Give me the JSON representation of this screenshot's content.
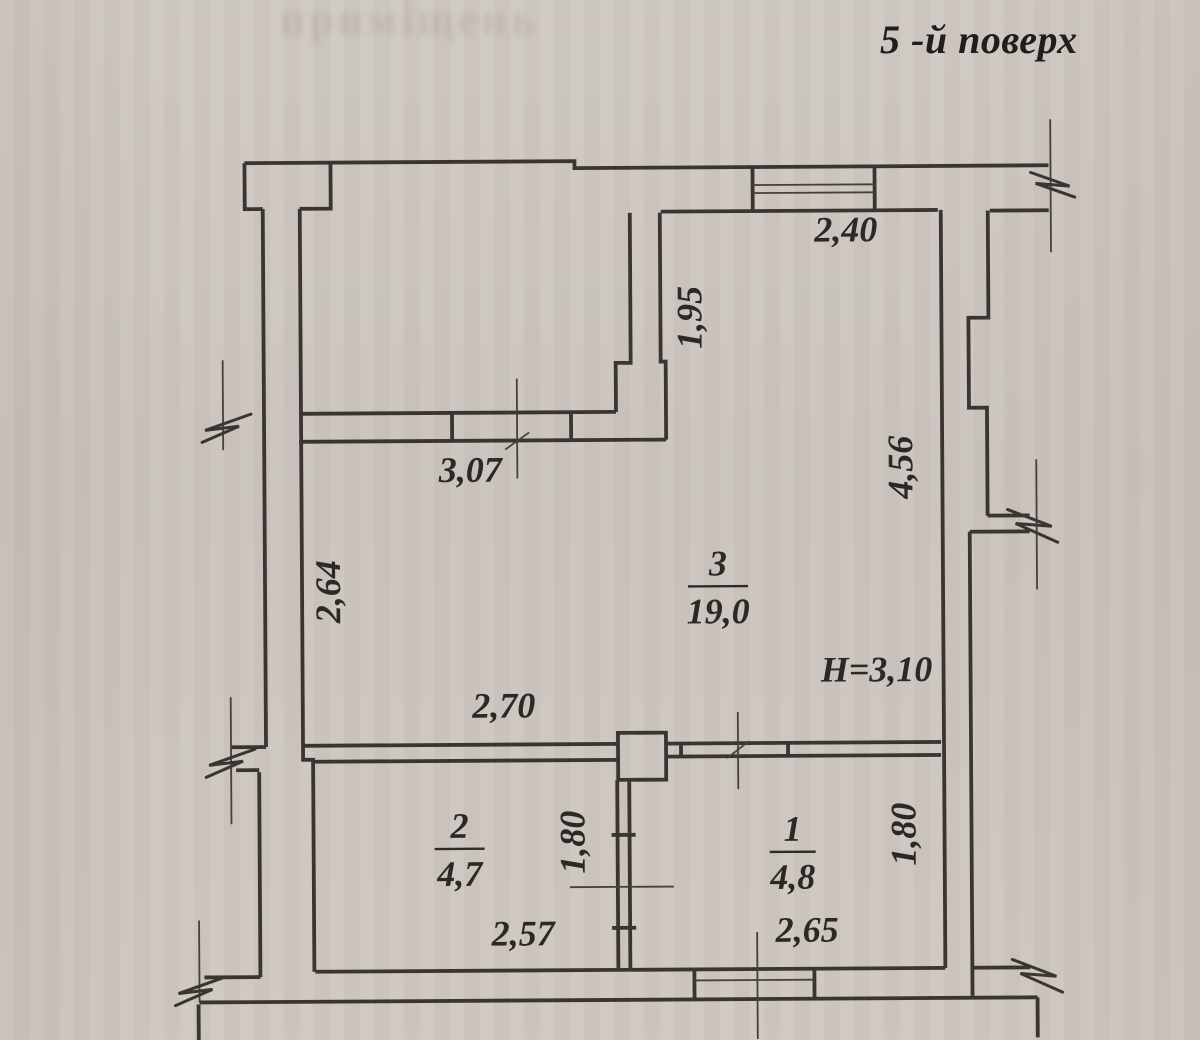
{
  "title": "5 -й поверх",
  "bleed_text": "приміщень",
  "colors": {
    "paper": "#cdc6c0",
    "ink": "#3a3531"
  },
  "floorplan": {
    "ceiling_height_note": "H=3,10",
    "walls": [
      "M247,161 H577 V168 H1051",
      "M247,161 V207 H265",
      "M302,207 H333 V161",
      "M265,207 V745",
      "M302,207 V758 H312 V970",
      "M258,770 V975",
      "M265,745 H230",
      "M258,768 H235",
      "M302,412 H617",
      "M300,440 H667",
      "M453,412 V440",
      "M572,412 V440",
      "M632,213 V363 H617 V412",
      "M662,213 V362 H667 V440",
      "M663,212 H940",
      "M755,168 V212",
      "M877,168 V212",
      "M943,212 V970",
      "M990,213 V320 H970 V410 H988 V518",
      "M992,213 H1051",
      "M988,518 H1030",
      "M970,534 H1030",
      "M970,534 V998",
      "M313,970 H943",
      "M692,970 V1000",
      "M812,970 V1000",
      "M197,1000 H1035",
      "M1035,1000 V1040",
      "M196,1002 V1040",
      "M258,975 H202",
      "M970,970 H1028",
      "M665,744 H940",
      "M665,757 H940",
      "M680,744 V757",
      "M787,744 V757",
      "M302,744 H617",
      "M312,760 H617",
      "M617,733 H665 V780 H617 Z",
      "M616,780 V970",
      "M628,780 V970",
      "M610,835 H634",
      "M610,928 H634"
    ],
    "thin_lines": [
      "M755,186 H877",
      "M755,194 H877",
      "M692,981 H812",
      "M518,378 V478",
      "M737,713 V790",
      "M568,887 H672",
      "M755,933 V1040",
      "M230,695 V822",
      "M224,358 V448",
      "M197,918 V1000",
      "M1037,462 V592",
      "M1053,122 V255",
      "M506,449 L530,432",
      "M726,759 L748,742"
    ],
    "break_marks": [
      "M252,412 L206,428 L240,424 L203,440",
      "M254,747 L208,763 L242,759 L205,775",
      "M222,975 L176,991 L210,987 L173,1003",
      "M1033,175 L1072,189 L1038,186 L1077,200",
      "M1008,512 L1052,529 L1016,526 L1058,545",
      "M1010,962 L1054,979 L1018,976 L1060,995"
    ],
    "dimensions": [
      {
        "text": "2,40",
        "x": 848,
        "y": 243,
        "rotate": 0
      },
      {
        "text": "1,95",
        "x": 703,
        "y": 318,
        "rotate": -90
      },
      {
        "text": "3,07",
        "x": 471,
        "y": 481,
        "rotate": 0
      },
      {
        "text": "4,56",
        "x": 913,
        "y": 469,
        "rotate": -90
      },
      {
        "text": "2,64",
        "x": 340,
        "y": 590,
        "rotate": -90
      },
      {
        "text": "H=3,10",
        "x": 876,
        "y": 683,
        "rotate": 0
      },
      {
        "text": "2,70",
        "x": 503,
        "y": 717,
        "rotate": 0
      },
      {
        "text": "1,80",
        "x": 583,
        "y": 842,
        "rotate": -90
      },
      {
        "text": "1,80",
        "x": 914,
        "y": 836,
        "rotate": -90
      },
      {
        "text": "2,57",
        "x": 521,
        "y": 945,
        "rotate": 0
      },
      {
        "text": "2,65",
        "x": 805,
        "y": 943,
        "rotate": 0
      }
    ],
    "rooms": [
      {
        "number": "3",
        "area": "19,0",
        "cx": 718,
        "bar": {
          "x1": 688,
          "x2": 748,
          "y": 587
        }
      },
      {
        "number": "2",
        "area": "4,7",
        "cx": 458,
        "bar": {
          "x1": 433,
          "x2": 483,
          "y": 848
        }
      },
      {
        "number": "1",
        "area": "4,8",
        "cx": 791,
        "bar": {
          "x1": 768,
          "x2": 814,
          "y": 853
        }
      }
    ]
  }
}
